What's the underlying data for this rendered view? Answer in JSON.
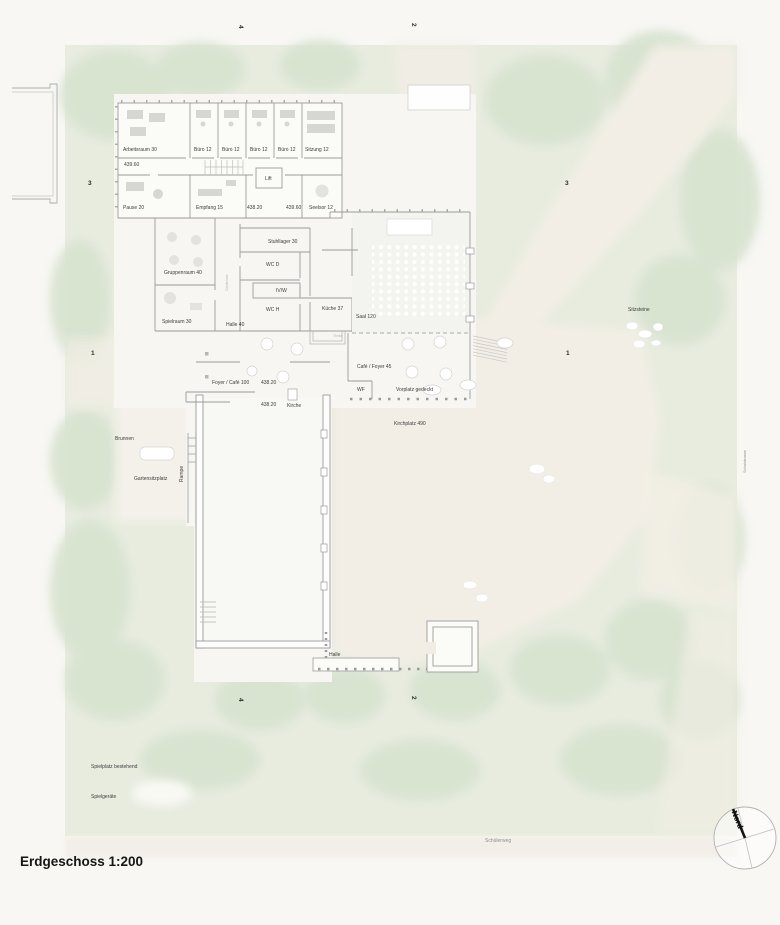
{
  "title": "Erdgeschoss 1:200",
  "north": {
    "label": "Nord"
  },
  "roads": {
    "right": "Schulstrasse",
    "bottom": "Schülerweg"
  },
  "grid": {
    "t1": "4",
    "t2": "2",
    "b1": "4",
    "b2": "2",
    "l1": "3",
    "l2": "1",
    "r1": "3",
    "r2": "1"
  },
  "labels": {
    "arbeitsraum": "Arbeitsraum 30",
    "buero_a": "Büro 12",
    "buero_b": "Büro 12",
    "buero_c": "Büro 12",
    "buero_d": "Büro 12",
    "sitzung": "Sitzung 12",
    "lvl43960a": "439.60",
    "lift": "Lift",
    "pause": "Pause 20",
    "empfang": "Empfang 15",
    "lvl43820a": "438.20",
    "lvl43960b": "439.60",
    "seelsorge": "Seelsor 12",
    "stuhllager": "Stuhllager 30",
    "wcd": "WC D",
    "ivw": "IV/W",
    "wch": "WC H",
    "kueche37": "Küche 37",
    "saal120": "Saal 120",
    "theke": "Theke",
    "gruppenraum": "Gruppenraum 40",
    "garderobe": "Garderobe",
    "spielraum": "Spielraum 30",
    "halle40": "Halle 40",
    "cafefoyer45": "Café / Foyer 45",
    "wf": "WF",
    "vorplatz": "Vorplatz gedeckt",
    "kirchplatz": "Kirchplatz 490",
    "foyercafe100": "Foyer / Café 100",
    "lvl43820b": "438.20",
    "lvl43820c": "438.20",
    "kirche": "Kirche",
    "halle": "Halle",
    "brunnen": "Brunnen",
    "rampe": "Rampe",
    "gartensitzplatz": "Gartensitzplatz",
    "sitzsteine": "Sitzsteine",
    "spielplatz": "Spielplatz bestehend",
    "spielgeraete": "Spielgeräte"
  },
  "colors": {
    "site_green": "#e7ecdf",
    "tree_green": "#d8e3d0",
    "path_beige": "#f2eee5",
    "plateau": "#f7f6f2",
    "wall_gray": "#9b9b9d",
    "text": "#3c3c3c"
  }
}
